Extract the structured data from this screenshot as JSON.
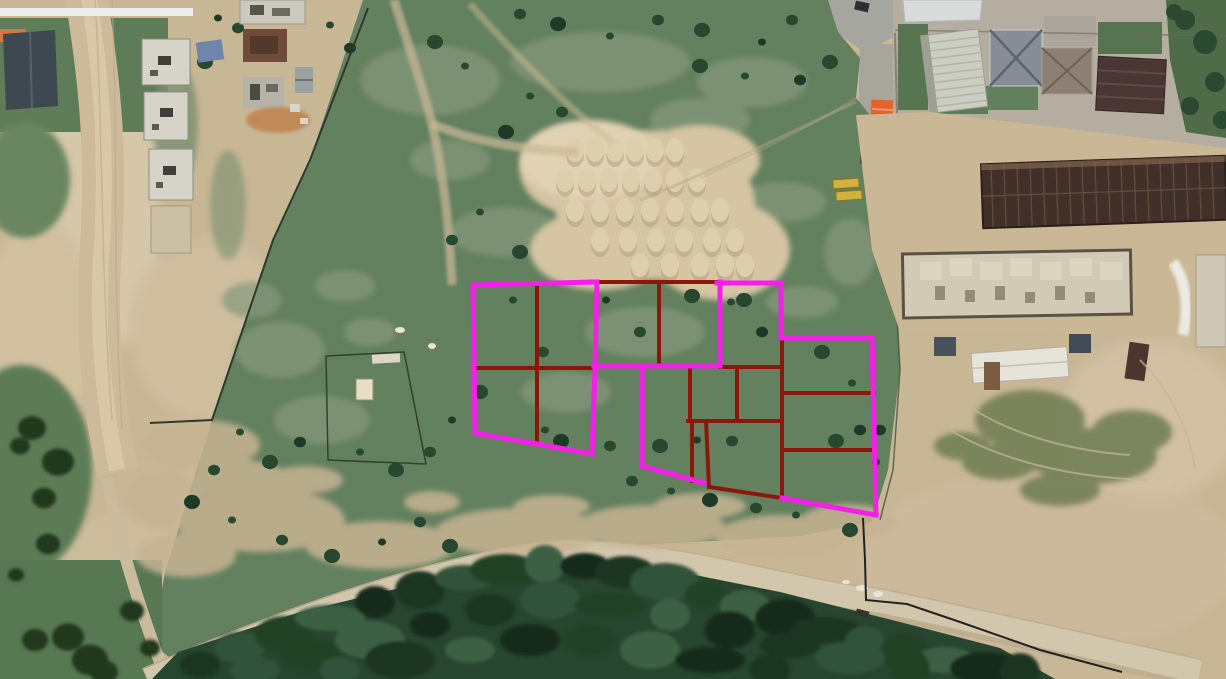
{
  "meta": {
    "view": "satellite-aerial-imagery",
    "description": "Aerial satellite view of grassland and construction area with land-parcel boundary overlay",
    "width_px": 1226,
    "height_px": 679
  },
  "colors": {
    "parcel_outline": "#f320e8",
    "parcel_divider": "#8c150c",
    "grass": "#63805f",
    "dirt_base": "#c8b795",
    "road": "#d2c6ac",
    "forest": "#27452f",
    "sand": "#d5c5a3",
    "white_strip": "#eceeee"
  },
  "overlay": {
    "outline_stroke_width": 5,
    "divider_stroke_width": 4,
    "parcel_outlines_magenta": [
      {
        "name": "left-block-outline",
        "closed": true,
        "points": [
          [
            473,
            285
          ],
          [
            597,
            282
          ],
          [
            595,
            368
          ],
          [
            592,
            454
          ],
          [
            537,
            444
          ],
          [
            475,
            433
          ]
        ]
      },
      {
        "name": "mid-top-bottom-boundary",
        "closed": false,
        "points": [
          [
            594,
            366
          ],
          [
            720,
            366
          ]
        ]
      },
      {
        "name": "top-right-block-left-edge",
        "closed": false,
        "points": [
          [
            720,
            282
          ],
          [
            720,
            366
          ]
        ]
      },
      {
        "name": "top-right-block-top-and-right",
        "closed": false,
        "points": [
          [
            717,
            283
          ],
          [
            781,
            283
          ],
          [
            781,
            338
          ]
        ]
      },
      {
        "name": "right-block-top-edge",
        "closed": false,
        "points": [
          [
            781,
            338
          ],
          [
            872,
            338
          ]
        ]
      },
      {
        "name": "right-block-right-edge",
        "closed": false,
        "points": [
          [
            872,
            338
          ],
          [
            876,
            515
          ]
        ]
      },
      {
        "name": "right-block-bottom-edge",
        "closed": false,
        "points": [
          [
            876,
            515
          ],
          [
            782,
            498
          ]
        ]
      },
      {
        "name": "middle-block-left-and-bottom",
        "closed": false,
        "points": [
          [
            642,
            366
          ],
          [
            642,
            466
          ],
          [
            704,
            483
          ]
        ]
      }
    ],
    "parcel_dividers_dark_red": [
      {
        "name": "left-block-vertical-divider",
        "points": [
          [
            537,
            283
          ],
          [
            537,
            444
          ]
        ]
      },
      {
        "name": "left-block-horizontal-divider",
        "points": [
          [
            475,
            368
          ],
          [
            595,
            368
          ]
        ]
      },
      {
        "name": "top-middle-top-edge",
        "points": [
          [
            596,
            282
          ],
          [
            720,
            282
          ]
        ]
      },
      {
        "name": "top-middle-vertical-divider",
        "points": [
          [
            659,
            282
          ],
          [
            659,
            366
          ]
        ]
      },
      {
        "name": "middle-right-top-edge",
        "points": [
          [
            720,
            367
          ],
          [
            782,
            367
          ]
        ]
      },
      {
        "name": "middle-box-left-vertical",
        "points": [
          [
            690,
            367
          ],
          [
            690,
            421
          ]
        ]
      },
      {
        "name": "middle-box-center-vertical",
        "points": [
          [
            737,
            367
          ],
          [
            737,
            421
          ]
        ]
      },
      {
        "name": "middle-box-horizontal",
        "points": [
          [
            688,
            421
          ],
          [
            782,
            421
          ]
        ]
      },
      {
        "name": "middle-lower-left-vertical",
        "points": [
          [
            692,
            421
          ],
          [
            692,
            481
          ]
        ]
      },
      {
        "name": "middle-lower-vertical",
        "points": [
          [
            706,
            421
          ],
          [
            709,
            487
          ]
        ]
      },
      {
        "name": "bottom-slant-divider",
        "points": [
          [
            709,
            487
          ],
          [
            782,
            498
          ]
        ]
      },
      {
        "name": "right-block-left-edge",
        "points": [
          [
            782,
            340
          ],
          [
            782,
            498
          ]
        ]
      },
      {
        "name": "right-block-divider-upper",
        "points": [
          [
            782,
            393
          ],
          [
            874,
            393
          ]
        ]
      },
      {
        "name": "right-block-divider-lower",
        "points": [
          [
            782,
            450
          ],
          [
            875,
            450
          ]
        ]
      }
    ]
  }
}
